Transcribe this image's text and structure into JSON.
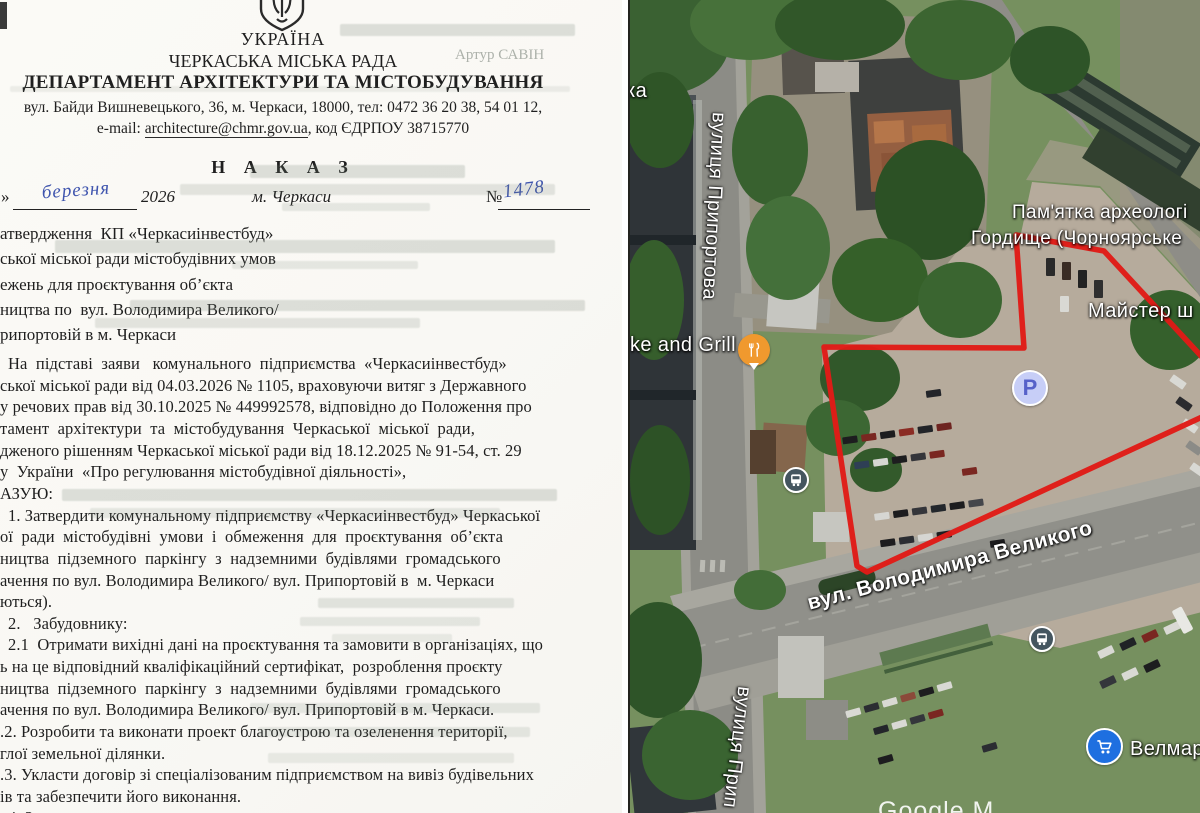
{
  "document": {
    "country": "УКРАЇНА",
    "council": "ЧЕРКАСЬКА МІСЬКА РАДА",
    "department": "ДЕПАРТАМЕНТ АРХІТЕКТУРИ ТА МІСТОБУДУВАННЯ",
    "address_line": "вул. Байди Вишневецького, 36, м. Черкаси, 18000, тел: 0472 36 20 38, 54 01 12,",
    "email_prefix": "e-mail: ",
    "email": "architecture@chmr.gov.ua",
    "email_suffix": ", код ЄДРПОУ 38715770",
    "order_title": "Н А К А З",
    "date_line": {
      "quote": "»",
      "month_handwritten": "березня",
      "year": "2026",
      "city": "м. Черкаси",
      "number_label": "№",
      "number_handwritten": "1478"
    },
    "subject_lines": [
      "атвердження  КП «Черкасиінвестбуд»",
      "ської міської ради містобудівних умов",
      "ежень для проєктування об’єкта",
      "ництва по  вул. Володимира Великого/",
      "рипортовій в м. Черкаси"
    ],
    "body_lines": [
      "На  підставі  заяви   комунального  підприємства  «Черкасиінвестбуд»",
      "ської міської ради від 04.03.2026 № 1105, враховуючи витяг з Державного",
      "у речових прав від 30.10.2025 № 449992578, відповідно до Положення про",
      "тамент  архітектури  та  містобудування  Черкаської  міської  ради,",
      "дженого рішенням Черкаської міської ради від 18.12.2025 № 91-54, ст. 29",
      "у  України  «Про регулювання містобудівної діяльності»,",
      "АЗУЮ:",
      "1. Затвердити комунальному підприємству «Черкасиінвестбуд» Черкаської",
      "ої  ради  містобудівні  умови  і  обмеження  для  проєктування  об’єкта",
      "ництва  підземного  паркінгу  з  надземними  будівлями  громадського",
      "ачення по вул. Володимира Великого/ вул. Припортовій в  м. Черкаси",
      "ються).",
      "2.   Забудовнику:",
      "2.1  Отримати вихідні дані на проєктування та замовити в організаціях, що",
      "ь на це відповідний кваліфікаційний сертифікат,  розроблення проєкту",
      "ництва  підземного  паркінгу  з  надземними  будівлями  громадського",
      "ачення по вул. Володимира Великого/ вул. Припортовій в м. Черкаси.",
      ".2. Розробити та виконати проект благоустрою та озеленення території,",
      "глої земельної ділянки.",
      ".3. Укласти договір зі спеціалізованим підприємством на вивіз будівельних",
      "ів та забезпечити його виконання."
    ],
    "partial_bottom_line": "4. З",
    "ghost_signature": "Артур САВІН"
  },
  "map": {
    "label_partial_top": "ка",
    "street_pryportova": "вулиця Припортова",
    "street_pryportova_partial": "вулиця Прип",
    "street_volodymyra": "вул. Володимира Великого",
    "poi_grill_label": "ke and Grill",
    "monument_line1": "Пам'ятка археологі",
    "monument_line2": "Гордище (Чорноярське",
    "poi_maister_label": "Майстер ш",
    "poi_velmart_label": "Велмарт",
    "parking_icon_letter": "P",
    "watermark_partial": "Google M",
    "colors": {
      "site_outline_red": "#e01b17",
      "parking_icon_bg": "#c7cef7",
      "parking_icon_fg": "#5661c9",
      "grill_pin_orange": "#f0992e",
      "velmart_blue": "#1e6fe0",
      "bus_icon_bg": "#44555f"
    }
  }
}
